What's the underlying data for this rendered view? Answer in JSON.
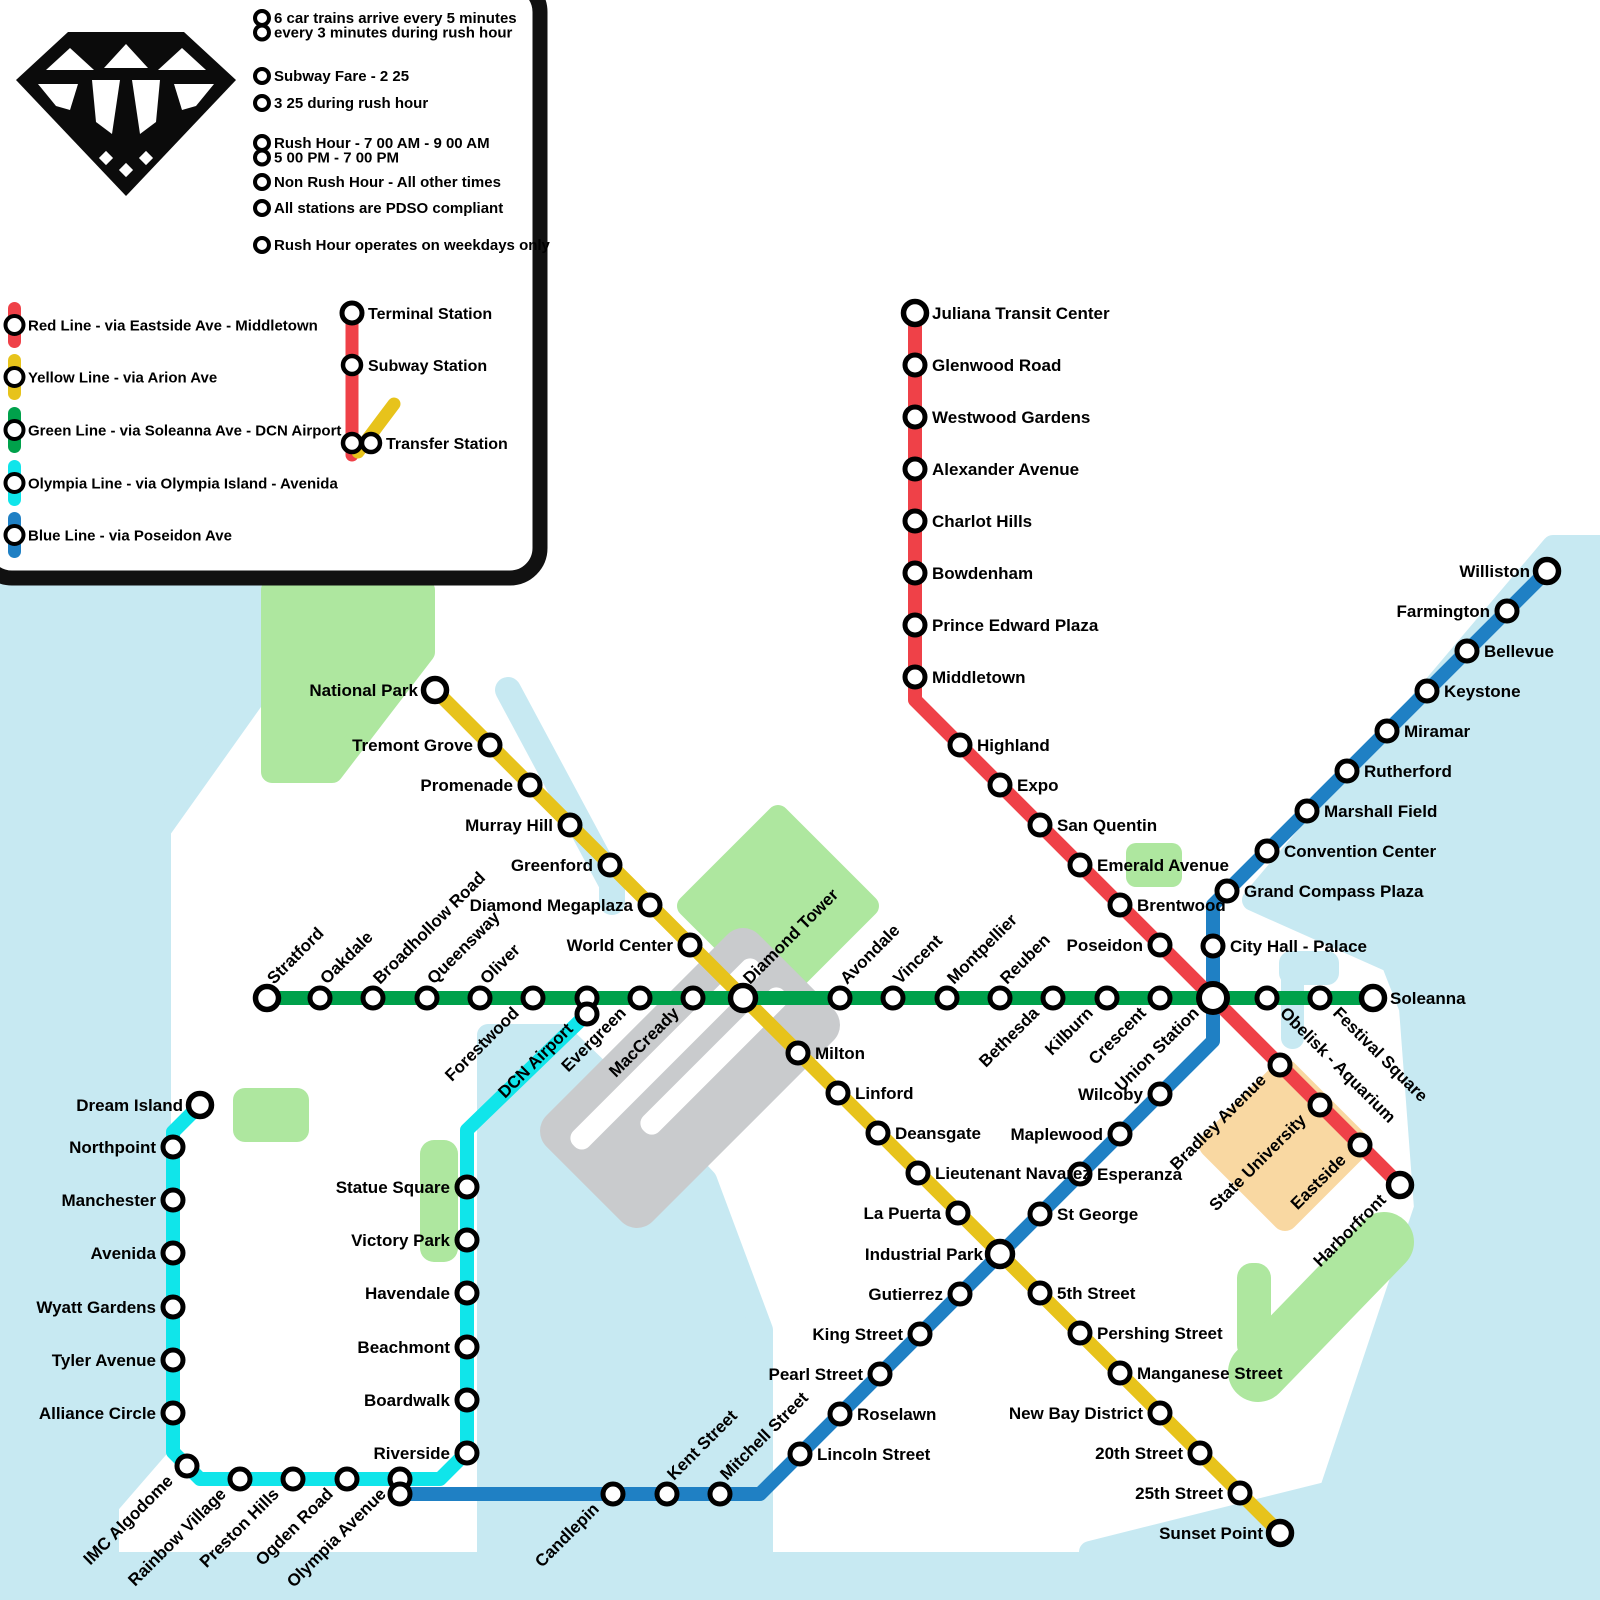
{
  "palette": {
    "red": "#EF4148",
    "yellow": "#E7C31B",
    "green": "#00A14B",
    "olympia": "#10E5EA",
    "blue": "#1F80C4",
    "water": "#C7E9F2",
    "park": "#AEE79F",
    "airport": "#C9CBCD",
    "university": "#F9D8A2",
    "ink": "#000000",
    "bg": "#FFFFFF"
  },
  "legend": {
    "info": [
      {
        "rows": [
          "6 car trains arrive every 5 minutes",
          "every 3 minutes during rush hour"
        ]
      },
      {
        "rows": [
          "Subway Fare - 2 25"
        ]
      },
      {
        "rows": [
          "3 25 during rush hour"
        ]
      },
      {
        "rows": [
          "Rush Hour - 7 00 AM - 9 00 AM",
          "5 00 PM - 7 00 PM"
        ]
      },
      {
        "rows": [
          "Non Rush Hour - All other times"
        ]
      },
      {
        "rows": [
          "All stations are PDSO compliant"
        ]
      },
      {
        "rows": [
          "Rush Hour operates on weekdays only"
        ]
      }
    ],
    "lines": [
      {
        "label": "Red Line - via Eastside Ave - Middletown",
        "color": "red"
      },
      {
        "label": "Yellow Line - via Arion Ave",
        "color": "yellow"
      },
      {
        "label": "Green Line - via Soleanna Ave - DCN Airport",
        "color": "green"
      },
      {
        "label": "Olympia Line - via Olympia Island - Avenida",
        "color": "olympia"
      },
      {
        "label": "Blue Line - via Poseidon Ave",
        "color": "blue"
      }
    ],
    "station_types": [
      {
        "label": "Terminal Station"
      },
      {
        "label": "Subway Station"
      },
      {
        "label": "Transfer Station"
      }
    ]
  },
  "map": {
    "lines": [
      {
        "id": "blue",
        "color": "blue",
        "points": [
          [
            1547,
            571
          ],
          [
            1227,
            891
          ],
          [
            1213,
            905
          ],
          [
            1213,
            1041
          ],
          [
            760,
            1494
          ],
          [
            400,
            1494
          ]
        ],
        "stations": [
          [
            "Williston",
            1547,
            571,
            "left",
            "term"
          ],
          [
            "Farmington",
            1507,
            611,
            "left"
          ],
          [
            "Bellevue",
            1467,
            651,
            "right"
          ],
          [
            "Keystone",
            1427,
            691,
            "right"
          ],
          [
            "Miramar",
            1387,
            731,
            "right"
          ],
          [
            "Rutherford",
            1347,
            771,
            "right"
          ],
          [
            "Marshall Field",
            1307,
            811,
            "right"
          ],
          [
            "Convention Center",
            1267,
            851,
            "right"
          ],
          [
            "Grand Compass Plaza",
            1227,
            891,
            "right"
          ],
          [
            "City Hall - Palace",
            1213,
            946,
            "right"
          ],
          [
            "Wilcoby",
            1160,
            1094,
            "left"
          ],
          [
            "Maplewood",
            1120,
            1134,
            "left"
          ],
          [
            "Esperanza",
            1080,
            1174,
            "right"
          ],
          [
            "St George",
            1040,
            1214,
            "right"
          ],
          [
            "Gutierrez",
            960,
            1294,
            "left"
          ],
          [
            "King Street",
            920,
            1334,
            "left"
          ],
          [
            "Pearl Street",
            880,
            1374,
            "left"
          ],
          [
            "Roselawn",
            840,
            1414,
            "right"
          ],
          [
            "Lincoln Street",
            800,
            1454,
            "right"
          ],
          [
            "Mitchell Street",
            720,
            1494,
            "up"
          ],
          [
            "Kent Street",
            667,
            1494,
            "up"
          ],
          [
            "Candlepin",
            613,
            1494,
            "dl"
          ]
        ]
      },
      {
        "id": "red",
        "color": "red",
        "points": [
          [
            915,
            313
          ],
          [
            915,
            700
          ],
          [
            1400,
            1185
          ]
        ],
        "stations": [
          [
            "Juliana Transit Center",
            915,
            313,
            "right",
            "term"
          ],
          [
            "Glenwood Road",
            915,
            365,
            "right"
          ],
          [
            "Westwood Gardens",
            915,
            417,
            "right"
          ],
          [
            "Alexander Avenue",
            915,
            469,
            "right"
          ],
          [
            "Charlot Hills",
            915,
            521,
            "right"
          ],
          [
            "Bowdenham",
            915,
            573,
            "right"
          ],
          [
            "Prince Edward Plaza",
            915,
            625,
            "right"
          ],
          [
            "Middletown",
            915,
            677,
            "right"
          ],
          [
            "Highland",
            960,
            745,
            "right"
          ],
          [
            "Expo",
            1000,
            785,
            "right"
          ],
          [
            "San Quentin",
            1040,
            825,
            "right"
          ],
          [
            "Emerald Avenue",
            1080,
            865,
            "right"
          ],
          [
            "Brentwood",
            1120,
            905,
            "right"
          ],
          [
            "Poseidon",
            1160,
            945,
            "left"
          ],
          [
            "Bradley Avenue",
            1280,
            1065,
            "dl"
          ],
          [
            "State University",
            1320,
            1105,
            "dl"
          ],
          [
            "Eastside",
            1360,
            1145,
            "dl"
          ],
          [
            "Harborfront",
            1400,
            1185,
            "dl",
            "term"
          ]
        ]
      },
      {
        "id": "yellow",
        "color": "yellow",
        "points": [
          [
            435,
            690
          ],
          [
            1280,
            1533
          ]
        ],
        "stations": [
          [
            "National Park",
            435,
            690,
            "left",
            "term"
          ],
          [
            "Tremont Grove",
            490,
            745,
            "left"
          ],
          [
            "Promenade",
            530,
            785,
            "left"
          ],
          [
            "Murray Hill",
            570,
            825,
            "left"
          ],
          [
            "Greenford",
            610,
            865,
            "left"
          ],
          [
            "Diamond Megaplaza",
            650,
            905,
            "left"
          ],
          [
            "World Center",
            690,
            945,
            "left"
          ],
          [
            "Milton",
            798,
            1053,
            "right"
          ],
          [
            "Linford",
            838,
            1093,
            "right"
          ],
          [
            "Deansgate",
            878,
            1133,
            "right"
          ],
          [
            "Lieutenant Navarez",
            918,
            1173,
            "right"
          ],
          [
            "La Puerta",
            958,
            1213,
            "left"
          ],
          [
            "5th Street",
            1040,
            1293,
            "right"
          ],
          [
            "Pershing Street",
            1080,
            1333,
            "right"
          ],
          [
            "Manganese Street",
            1120,
            1373,
            "right"
          ],
          [
            "New Bay District",
            1160,
            1413,
            "left"
          ],
          [
            "20th Street",
            1200,
            1453,
            "left"
          ],
          [
            "25th Street",
            1240,
            1493,
            "left"
          ],
          [
            "Sunset Point",
            1280,
            1533,
            "left",
            "term"
          ]
        ]
      },
      {
        "id": "olympia",
        "color": "olympia",
        "points": [
          [
            200,
            1105
          ],
          [
            173,
            1132
          ],
          [
            173,
            1452
          ],
          [
            200,
            1479
          ],
          [
            440,
            1479
          ],
          [
            467,
            1452
          ],
          [
            467,
            1130
          ],
          [
            587,
            1014
          ]
        ],
        "stations": [
          [
            "Dream Island",
            200,
            1105,
            "left",
            "term"
          ],
          [
            "Northpoint",
            173,
            1147,
            "left"
          ],
          [
            "Manchester",
            173,
            1200,
            "left"
          ],
          [
            "Avenida",
            173,
            1253,
            "left"
          ],
          [
            "Wyatt Gardens",
            173,
            1307,
            "left"
          ],
          [
            "Tyler Avenue",
            173,
            1360,
            "left"
          ],
          [
            "Alliance Circle",
            173,
            1413,
            "left"
          ],
          [
            "IMC Algodome",
            187,
            1466,
            "dl"
          ],
          [
            "Rainbow Village",
            240,
            1479,
            "dl"
          ],
          [
            "Preston Hills",
            293,
            1479,
            "dl"
          ],
          [
            "Ogden Road",
            347,
            1479,
            "dl"
          ],
          [
            "Riverside",
            467,
            1453,
            "left"
          ],
          [
            "Boardwalk",
            467,
            1400,
            "left"
          ],
          [
            "Beachmont",
            467,
            1347,
            "left"
          ],
          [
            "Havendale",
            467,
            1293,
            "left"
          ],
          [
            "Victory Park",
            467,
            1240,
            "left"
          ],
          [
            "Statue Square",
            467,
            1187,
            "left"
          ]
        ]
      },
      {
        "id": "green",
        "color": "green",
        "points": [
          [
            267,
            998
          ],
          [
            1373,
            998
          ]
        ],
        "stations": [
          [
            "Stratford",
            267,
            998,
            "up",
            "term"
          ],
          [
            "Oakdale",
            320,
            998,
            "up"
          ],
          [
            "Broadhollow Road",
            373,
            998,
            "up"
          ],
          [
            "Queensway",
            427,
            998,
            "up"
          ],
          [
            "Oliver",
            480,
            998,
            "up"
          ],
          [
            "Forestwood",
            533,
            998,
            "dl"
          ],
          [
            "Evergreen",
            640,
            998,
            "dl"
          ],
          [
            "MacCready",
            693,
            998,
            "dl"
          ],
          [
            "Avondale",
            840,
            998,
            "up"
          ],
          [
            "Vincent",
            893,
            998,
            "up"
          ],
          [
            "Montpellier",
            947,
            998,
            "up"
          ],
          [
            "Reuben",
            1000,
            998,
            "up"
          ],
          [
            "Bethesda",
            1053,
            998,
            "dl"
          ],
          [
            "Kilburn",
            1107,
            998,
            "dl"
          ],
          [
            "Crescent",
            1160,
            998,
            "dl"
          ],
          [
            "Obelisk - Aquarium",
            1267,
            998,
            "dr"
          ],
          [
            "Festival Square",
            1320,
            998,
            "dr"
          ],
          [
            "Soleanna",
            1373,
            998,
            "right",
            "term"
          ]
        ]
      }
    ],
    "interchanges": [
      {
        "name": "Union Station",
        "x": 1213,
        "y": 998,
        "label": "dl",
        "style": "hub"
      },
      {
        "name": "Diamond Tower",
        "x": 743,
        "y": 998,
        "label": "up",
        "style": "xfer"
      },
      {
        "name": "Industrial Park",
        "x": 1000,
        "y": 1254,
        "label": "left",
        "style": "xfer"
      },
      {
        "name": "DCN Airport",
        "x": 587,
        "y": 998,
        "x2": 587,
        "y2": 1014,
        "label": "dl",
        "labelAt": "second",
        "style": "pair"
      },
      {
        "name": "Olympia Avenue",
        "x": 400,
        "y": 1479,
        "x2": 400,
        "y2": 1494,
        "label": "dl",
        "labelAt": "first",
        "style": "pair"
      }
    ],
    "areas": {
      "water": [
        {
          "type": "poly",
          "pts": [
            [
              1553,
              546
            ],
            [
              1600,
              546
            ],
            [
              1600,
              1552
            ],
            [
              1090,
              1552
            ],
            [
              1330,
              1492
            ],
            [
              1425,
              1208
            ],
            [
              1410,
              1008
            ],
            [
              1392,
              962
            ],
            [
              1253,
              900
            ]
          ]
        },
        {
          "type": "rect",
          "x": 1279,
          "y": 951,
          "w": 60,
          "h": 34,
          "r": 12
        },
        {
          "type": "rect",
          "x": 1281,
          "y": 951,
          "w": 23,
          "h": 98,
          "r": 11
        },
        {
          "type": "poly",
          "pts": [
            [
              0,
              588
            ],
            [
              256,
              588
            ],
            [
              256,
              695
            ],
            [
              160,
              830
            ],
            [
              160,
              1445
            ],
            [
              108,
              1505
            ],
            [
              108,
              1552
            ],
            [
              0,
              1552
            ]
          ]
        },
        {
          "type": "rect",
          "x": 0,
          "y": 1552,
          "w": 1600,
          "h": 48,
          "r": 0
        },
        {
          "type": "stroke",
          "pts": [
            [
              508,
              690
            ],
            [
              612,
              884
            ],
            [
              612,
              902
            ]
          ],
          "w": 26
        },
        {
          "type": "poly",
          "pts": [
            [
              488,
              1035
            ],
            [
              562,
              1035
            ],
            [
              648,
              1118
            ],
            [
              706,
              1180
            ],
            [
              762,
              1330
            ],
            [
              762,
              1552
            ],
            [
              488,
              1552
            ]
          ]
        }
      ],
      "parks": [
        {
          "type": "poly",
          "pts": [
            [
              272,
              590
            ],
            [
              424,
              590
            ],
            [
              424,
              652
            ],
            [
              332,
              772
            ],
            [
              272,
              772
            ]
          ]
        },
        {
          "type": "rect",
          "x": 233,
          "y": 1088,
          "w": 76,
          "h": 54,
          "r": 12
        },
        {
          "type": "rect",
          "x": 420,
          "y": 1140,
          "w": 38,
          "h": 122,
          "r": 14
        },
        {
          "type": "poly",
          "pts": [
            [
              778,
              816
            ],
            [
              868,
              906
            ],
            [
              778,
              996
            ],
            [
              688,
              906
            ]
          ]
        },
        {
          "type": "rect",
          "x": 1126,
          "y": 843,
          "w": 56,
          "h": 44,
          "r": 10
        },
        {
          "type": "rect",
          "x": 1237,
          "y": 1263,
          "w": 34,
          "h": 97,
          "r": 15
        },
        {
          "type": "stroke",
          "pts": [
            [
              1258,
              1372
            ],
            [
              1384,
              1242
            ]
          ],
          "w": 60
        }
      ],
      "airport": {
        "cx": 690,
        "cy": 1078,
        "rot": 45,
        "w": 150,
        "h": 300,
        "runways": [
          [
            -45,
            -130,
            22,
            260
          ],
          [
            -6,
            -128,
            22,
            198
          ]
        ]
      },
      "university": {
        "pts": [
          [
            1285,
            1072
          ],
          [
            1358,
            1145
          ],
          [
            1285,
            1218
          ],
          [
            1212,
            1145
          ]
        ]
      }
    }
  }
}
